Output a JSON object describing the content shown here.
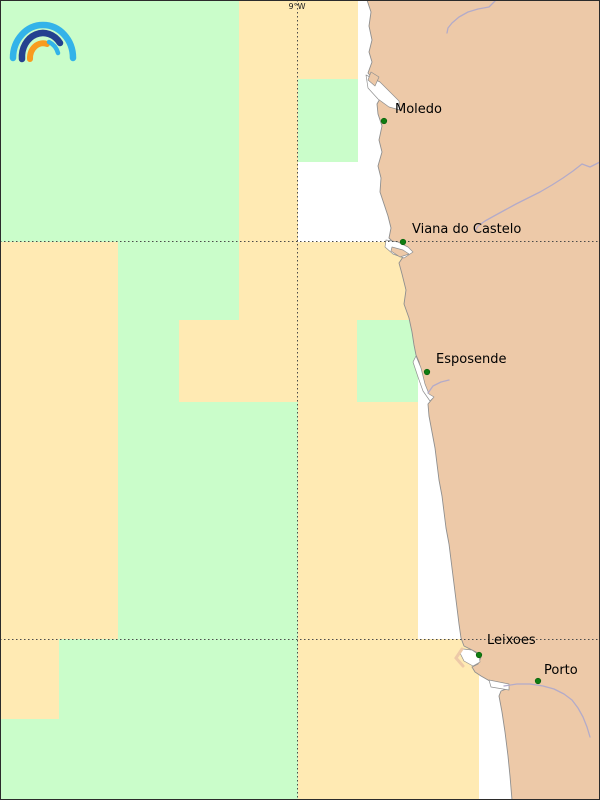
{
  "map": {
    "description": "coastal-forecast-grid-map",
    "colors": {
      "g": "#cafdca",
      "o": "#ffeab3",
      "land": "#edc9a8",
      "sea": "#ffffff",
      "coast": "#8f8f8f",
      "river": "#b3abc9",
      "grid": "#4a4a4a",
      "dot": "#0f7d11",
      "dot_edge": "#0b5e0d",
      "label": "#000000",
      "frame": "#2b2b2b",
      "logo_sky": "#33b3e9",
      "logo_navy": "#24418f",
      "logo_orange": "#f89b1f"
    },
    "gridlines": {
      "label": "9°W",
      "label_x": 297,
      "label_baseline": 9,
      "vertical_x": 297.5,
      "horizontal_y": [
        241.5,
        639.5
      ]
    },
    "cells": [
      [
        0,
        0,
        239,
        242,
        "g"
      ],
      [
        239,
        0,
        59,
        242,
        "o"
      ],
      [
        298,
        0,
        60,
        79,
        "o"
      ],
      [
        298,
        79,
        60,
        83,
        "g"
      ],
      [
        0,
        242,
        118,
        397,
        "o"
      ],
      [
        118,
        242,
        121,
        78,
        "g"
      ],
      [
        239,
        242,
        59,
        160,
        "o"
      ],
      [
        118,
        320,
        61,
        82,
        "g"
      ],
      [
        179,
        320,
        60,
        82,
        "o"
      ],
      [
        118,
        402,
        180,
        237,
        "g"
      ],
      [
        298,
        242,
        120,
        78,
        "o"
      ],
      [
        298,
        320,
        59,
        82,
        "o"
      ],
      [
        357,
        320,
        61,
        82,
        "g"
      ],
      [
        298,
        402,
        120,
        237,
        "o"
      ],
      [
        0,
        639,
        59,
        80,
        "o"
      ],
      [
        0,
        719,
        59,
        81,
        "g"
      ],
      [
        59,
        639,
        239,
        161,
        "g"
      ],
      [
        298,
        639,
        181,
        161,
        "o"
      ]
    ],
    "cities": [
      {
        "name": "Moledo",
        "dot": [
          384,
          121
        ],
        "label": [
          395,
          113
        ]
      },
      {
        "name": "Viana do Castelo",
        "dot": [
          403,
          242
        ],
        "label": [
          412,
          233
        ]
      },
      {
        "name": "Esposende",
        "dot": [
          427,
          372
        ],
        "label": [
          436,
          363
        ]
      },
      {
        "name": "Leixoes",
        "dot": [
          479,
          655
        ],
        "label": [
          487,
          644
        ]
      },
      {
        "name": "Porto",
        "dot": [
          538,
          681
        ],
        "label": [
          544,
          674
        ]
      }
    ],
    "geometry": {
      "land": [
        [
          367,
          0
        ],
        [
          371,
          12
        ],
        [
          369,
          26
        ],
        [
          372,
          40
        ],
        [
          369,
          52
        ],
        [
          372,
          62
        ],
        [
          368,
          73
        ],
        [
          377,
          84
        ],
        [
          382,
          95
        ],
        [
          377,
          104
        ],
        [
          378,
          114
        ],
        [
          382,
          126
        ],
        [
          379,
          140
        ],
        [
          382,
          152
        ],
        [
          378,
          166
        ],
        [
          381,
          178
        ],
        [
          380,
          192
        ],
        [
          384,
          204
        ],
        [
          388,
          216
        ],
        [
          391,
          228
        ],
        [
          389,
          238
        ],
        [
          394,
          243
        ],
        [
          404,
          247
        ],
        [
          410,
          251
        ],
        [
          403,
          257
        ],
        [
          399,
          263
        ],
        [
          402,
          274
        ],
        [
          406,
          290
        ],
        [
          404,
          304
        ],
        [
          409,
          318
        ],
        [
          412,
          332
        ],
        [
          414,
          345
        ],
        [
          416,
          355
        ],
        [
          419,
          362
        ],
        [
          422,
          375
        ],
        [
          425,
          388
        ],
        [
          429,
          396
        ],
        [
          433,
          398
        ],
        [
          428,
          404
        ],
        [
          429,
          416
        ],
        [
          432,
          432
        ],
        [
          435,
          448
        ],
        [
          437,
          464
        ],
        [
          439,
          480
        ],
        [
          442,
          496
        ],
        [
          444,
          512
        ],
        [
          446,
          528
        ],
        [
          449,
          544
        ],
        [
          451,
          560
        ],
        [
          453,
          576
        ],
        [
          455,
          592
        ],
        [
          457,
          608
        ],
        [
          459,
          624
        ],
        [
          461,
          638
        ],
        [
          464,
          646
        ],
        [
          470,
          649
        ],
        [
          476,
          652
        ],
        [
          481,
          657
        ],
        [
          478,
          664
        ],
        [
          472,
          667
        ],
        [
          475,
          672
        ],
        [
          481,
          676
        ],
        [
          488,
          680
        ],
        [
          493,
          683
        ],
        [
          505,
          685
        ],
        [
          509,
          688
        ],
        [
          501,
          691
        ],
        [
          499,
          696
        ],
        [
          502,
          712
        ],
        [
          505,
          732
        ],
        [
          508,
          756
        ],
        [
          510,
          776
        ],
        [
          512,
          800
        ],
        [
          600,
          800
        ],
        [
          600,
          0
        ]
      ],
      "estuaries": [
        {
          "name": "minho-estuary",
          "pts": [
            [
              366,
              75
            ],
            [
              380,
              82
            ],
            [
              390,
              92
            ],
            [
              399,
              101
            ],
            [
              400,
              110
            ],
            [
              389,
              107
            ],
            [
              378,
              99
            ],
            [
              368,
              88
            ]
          ]
        },
        {
          "name": "lima-estuary",
          "pts": [
            [
              386,
              240
            ],
            [
              398,
              242
            ],
            [
              408,
              247
            ],
            [
              413,
              252
            ],
            [
              404,
              258
            ],
            [
              393,
              254
            ],
            [
              385,
              247
            ]
          ]
        },
        {
          "name": "cavado-lagoon",
          "pts": [
            [
              416,
              356
            ],
            [
              421,
              368
            ],
            [
              425,
              384
            ],
            [
              429,
              394
            ],
            [
              434,
              397
            ],
            [
              430,
              401
            ],
            [
              423,
              391
            ],
            [
              418,
              377
            ],
            [
              413,
              362
            ]
          ]
        },
        {
          "name": "leixoes-harbor",
          "pts": [
            [
              463,
              649
            ],
            [
              472,
              650
            ],
            [
              479,
              655
            ],
            [
              480,
              662
            ],
            [
              473,
              666
            ],
            [
              464,
              661
            ],
            [
              460,
              653
            ]
          ]
        },
        {
          "name": "douro-estuary",
          "pts": [
            [
              489,
              680
            ],
            [
              509,
              684
            ],
            [
              509,
              690
            ],
            [
              491,
              687
            ]
          ]
        }
      ],
      "land_details": [
        {
          "name": "minho-spit",
          "pts": [
            [
              371,
              72
            ],
            [
              379,
              77
            ],
            [
              375,
              86
            ],
            [
              368,
              80
            ]
          ]
        },
        {
          "name": "viana-spit",
          "pts": [
            [
              392,
              247
            ],
            [
              403,
              250
            ],
            [
              409,
              254
            ],
            [
              400,
              257
            ],
            [
              391,
              251
            ]
          ]
        }
      ],
      "leixoes_breakwater": [
        [
          462,
          649
        ],
        [
          456,
          658
        ],
        [
          463,
          666
        ]
      ],
      "rivers": [
        {
          "name": "river-minho",
          "pts": [
            [
              496,
              0
            ],
            [
              489,
              7
            ],
            [
              478,
              9
            ],
            [
              468,
              12
            ],
            [
              459,
              17
            ],
            [
              452,
              23
            ],
            [
              448,
              28
            ],
            [
              447,
              33
            ]
          ]
        },
        {
          "name": "river-lima",
          "pts": [
            [
              600,
              162
            ],
            [
              590,
              167
            ],
            [
              582,
              164
            ],
            [
              573,
              171
            ],
            [
              563,
              178
            ],
            [
              552,
              185
            ],
            [
              540,
              192
            ],
            [
              528,
              198
            ],
            [
              516,
              204
            ],
            [
              505,
              210
            ],
            [
              494,
              216
            ],
            [
              485,
              221
            ],
            [
              478,
              226
            ],
            [
              475,
              231
            ]
          ]
        },
        {
          "name": "river-douro",
          "pts": [
            [
              504,
              686
            ],
            [
              517,
              684
            ],
            [
              530,
              684
            ],
            [
              543,
              686
            ],
            [
              554,
              689
            ],
            [
              564,
              694
            ],
            [
              572,
              700
            ],
            [
              578,
              708
            ],
            [
              583,
              717
            ],
            [
              587,
              727
            ],
            [
              590,
              737
            ]
          ]
        },
        {
          "name": "river-cavado",
          "pts": [
            [
              449,
              380
            ],
            [
              441,
              382
            ],
            [
              433,
              386
            ],
            [
              428,
              393
            ]
          ]
        }
      ]
    },
    "logo": {
      "arcs": [
        {
          "name": "logo-arc-outer-sky",
          "d": "M 13 58 A 30 33 0 0 1 73 58",
          "color_key": "logo_sky",
          "w": 6.5
        },
        {
          "name": "logo-arc-navy",
          "d": "M 22 59 A 21 24 0 0 1 60 43",
          "color_key": "logo_navy",
          "w": 6.5
        },
        {
          "name": "logo-arc-orange",
          "d": "M 30 59 A 13 15 0 0 1 47 44",
          "color_key": "logo_orange",
          "w": 6
        },
        {
          "name": "logo-arc-inner-sky",
          "d": "M 49 42 A 16 18 0 0 1 58 53",
          "color_key": "logo_sky",
          "w": 4.5
        }
      ]
    },
    "label_font_px": 13,
    "grid_label_font_px": 8
  }
}
